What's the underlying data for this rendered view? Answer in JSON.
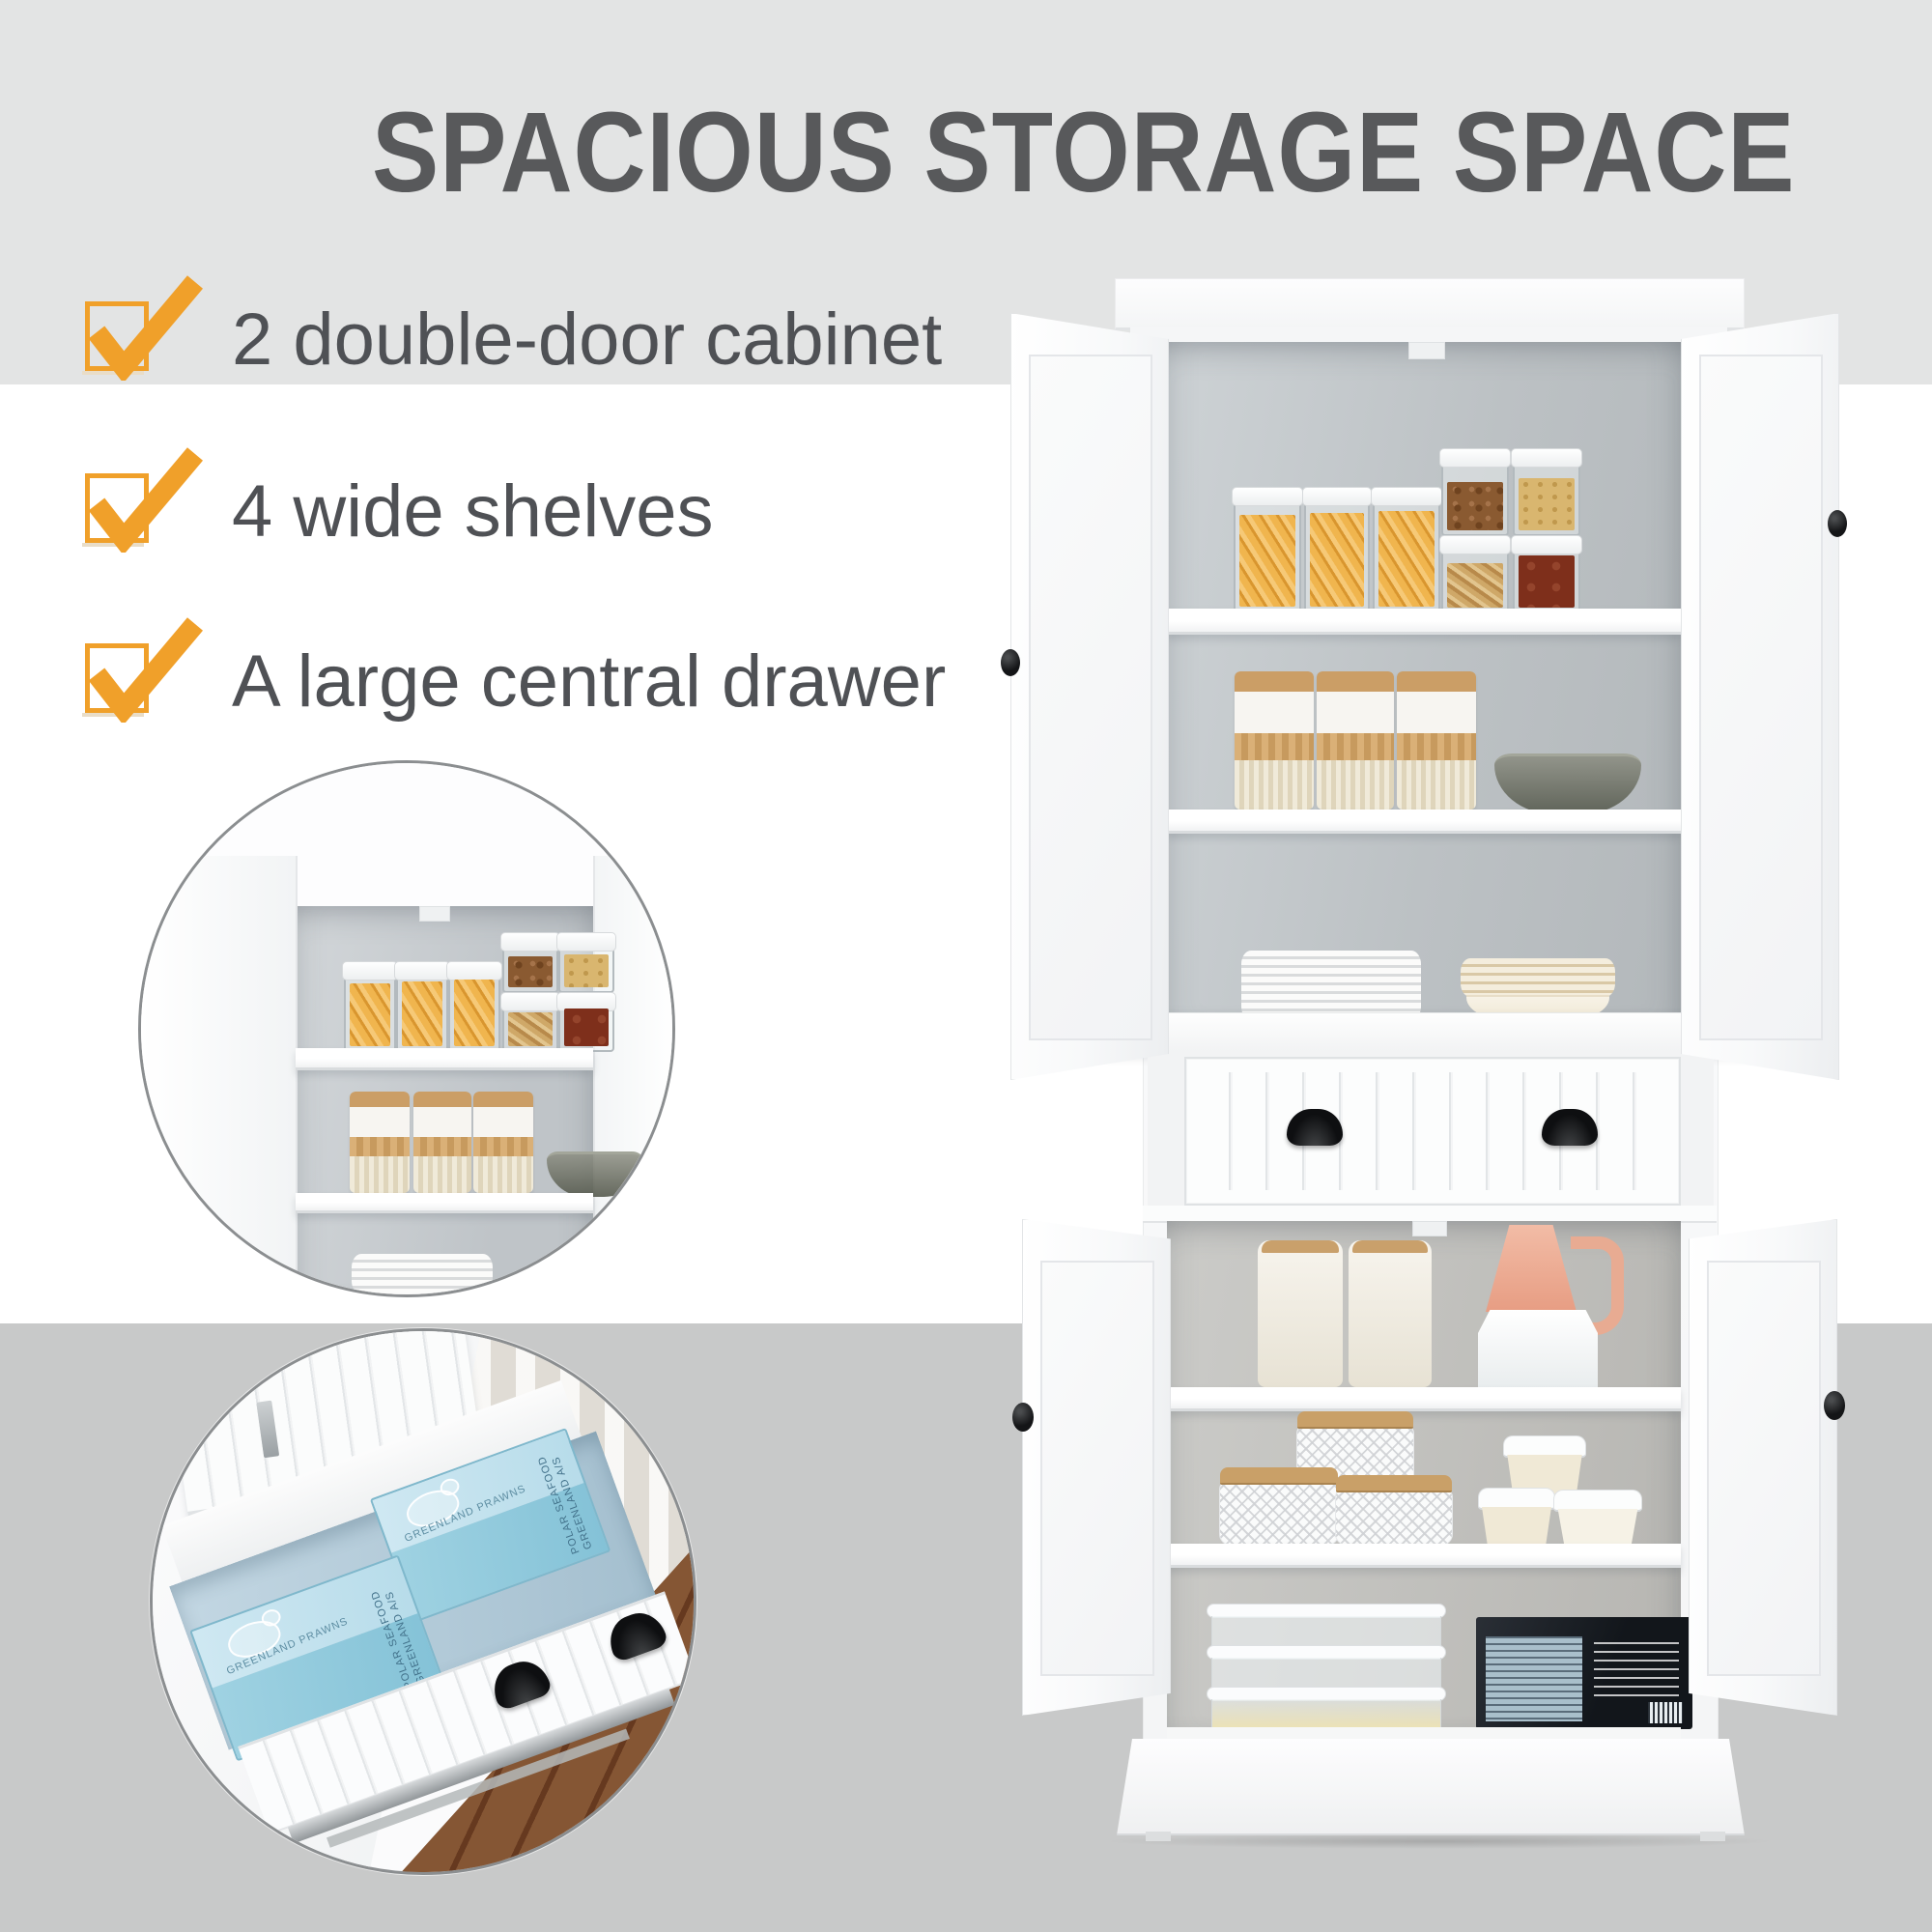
{
  "title": {
    "text": "SPACIOUS STORAGE SPACE",
    "color": "#58595b"
  },
  "checklist": {
    "check_color": "#f0a02a",
    "text_color": "#4f5155",
    "items": [
      {
        "label": "2 double-door cabinet"
      },
      {
        "label": "4 wide shelves"
      },
      {
        "label": "A large central drawer"
      }
    ]
  },
  "insets": [
    {
      "name": "top-cabinet-interior-closeup"
    },
    {
      "name": "open-drawer-closeup"
    }
  ],
  "drawer_boxes": {
    "top_text": "GREENLAND PRAWNS",
    "side_text": "POLAR SEAFOOD GREENLAND A/S"
  },
  "palette": {
    "band_top": "#e3e4e4",
    "band_bottom": "#c8c9c9",
    "canvas": "#ffffff",
    "cabinet_white": "#fbfbfc",
    "interior_gray": "#c2c7ca",
    "handle_black": "#141517",
    "pasta_amber": "#e8a93c",
    "wood_lid": "#c89c64",
    "drawer_interior_blue": "#b5cdda",
    "seafood_box_blue": "#a7d4e4",
    "floor_brown": "#7c5134"
  }
}
